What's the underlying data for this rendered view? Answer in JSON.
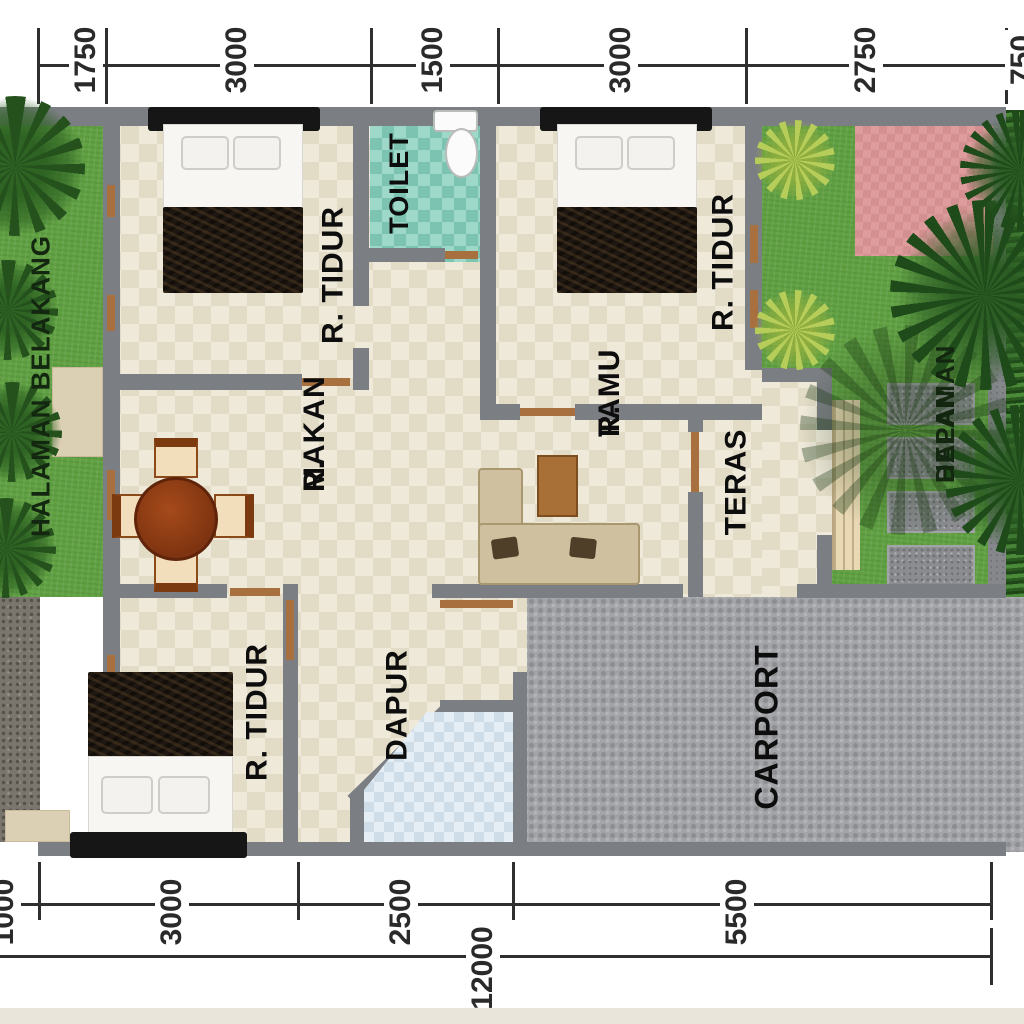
{
  "plan": {
    "rooms": {
      "bedroom_top_left": "R. TIDUR",
      "toilet": "TOILET",
      "bedroom_top_right": "R. TIDUR",
      "dining_line1": "R.",
      "dining_line2": "MAKAN",
      "living_line1": "R.",
      "living_line2": "TAMU",
      "terrace": "TERAS",
      "kitchen": "DAPUR",
      "bedroom_bottom_left": "R. TIDUR",
      "carport": "CARPORT",
      "backyard": "HALAMAN BELAKANG",
      "frontyard_line1": "HALAMAN",
      "frontyard_line2": "DEPAN"
    },
    "dimensions": {
      "top": [
        "1750",
        "3000",
        "1500",
        "3000",
        "2750",
        "750"
      ],
      "bottom": [
        "1000",
        "3000",
        "2500",
        "5500"
      ],
      "total": "12000"
    },
    "colors": {
      "wall": "#7b7e83",
      "floor_tile": "#efe9da",
      "toilet_floor": "#9ed8c9",
      "grass": "#61a143",
      "carport": "#a3a4a7",
      "terrace_pink": "#df9c9d",
      "wood_accent": "#a9703f"
    }
  }
}
